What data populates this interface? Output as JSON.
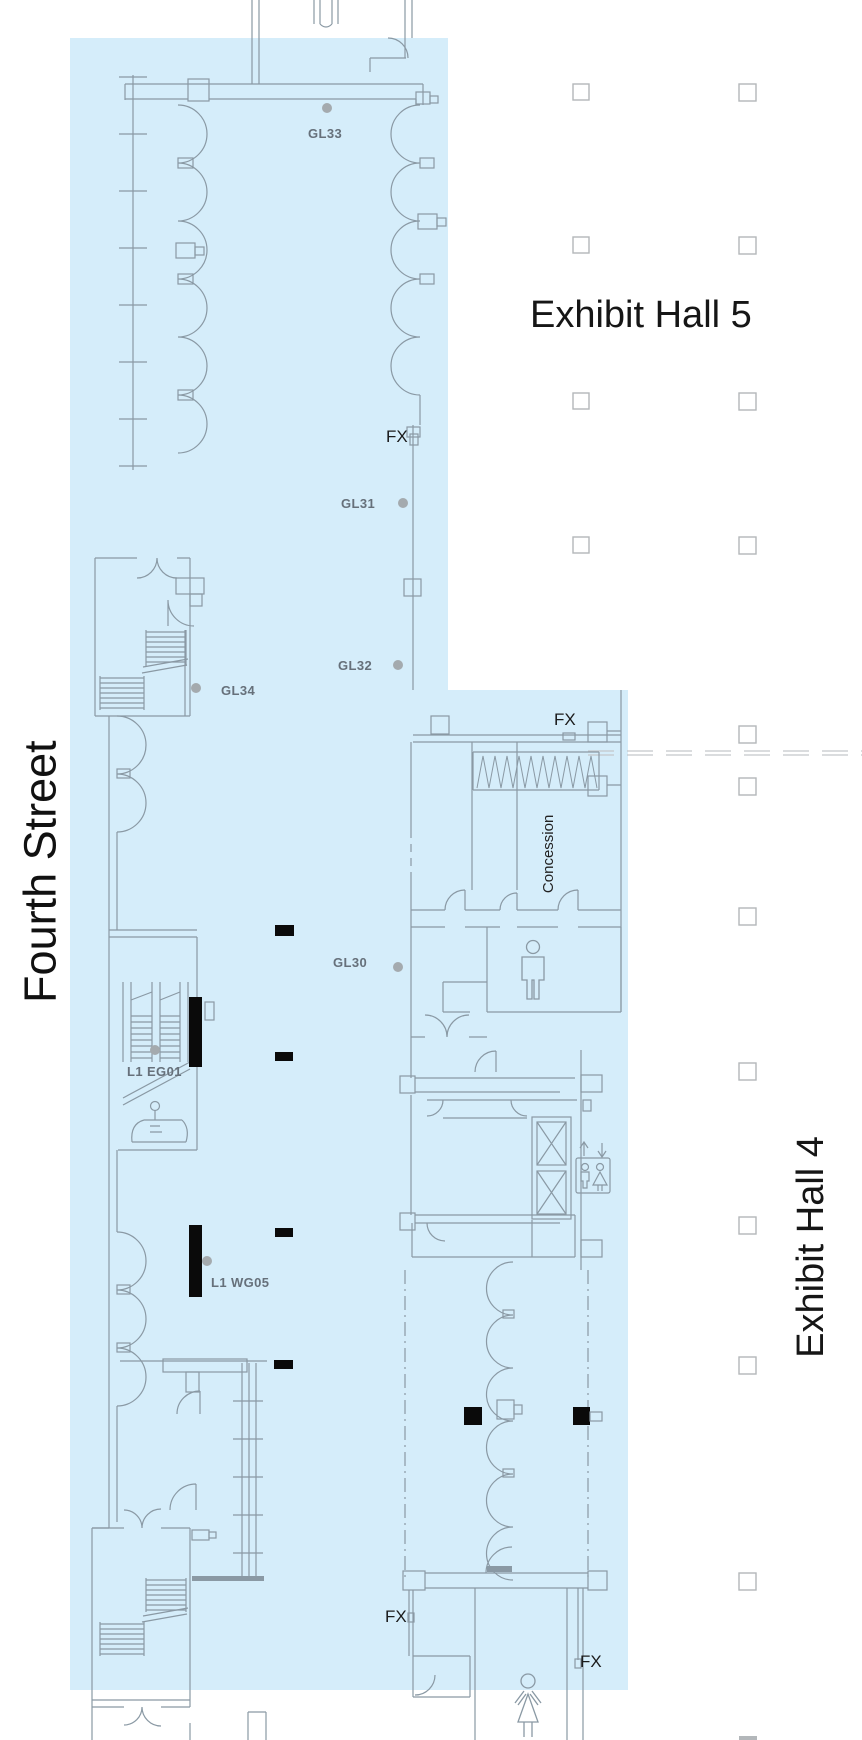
{
  "map": {
    "halls": {
      "hall5": "Exhibit Hall 5",
      "hall4": "Exhibit Hall 4"
    },
    "street": "Fourth Street",
    "concession": "Concession",
    "markers": {
      "gl33": "GL33",
      "gl31": "GL31",
      "gl32": "GL32",
      "gl34": "GL34",
      "gl30": "GL30",
      "eg01": "L1 EG01",
      "wg05": "L1 WG05",
      "fx": "FX"
    },
    "icons": {
      "mens_restroom": "man-figure",
      "womens_restroom": "woman-figure",
      "escalator": "escalator-with-person",
      "elevator": "elevator-up-down-arrows-figures"
    },
    "colors": {
      "concourse_fill": "#d5edfa",
      "wall_line": "#8a99a4",
      "light_line": "#b9c2c8",
      "column_line": "#b3b7ba",
      "label_gray": "#66707a",
      "dot_gray": "#a4aaae",
      "text_black": "#1b1b1b",
      "black_fill": "#000000"
    }
  }
}
